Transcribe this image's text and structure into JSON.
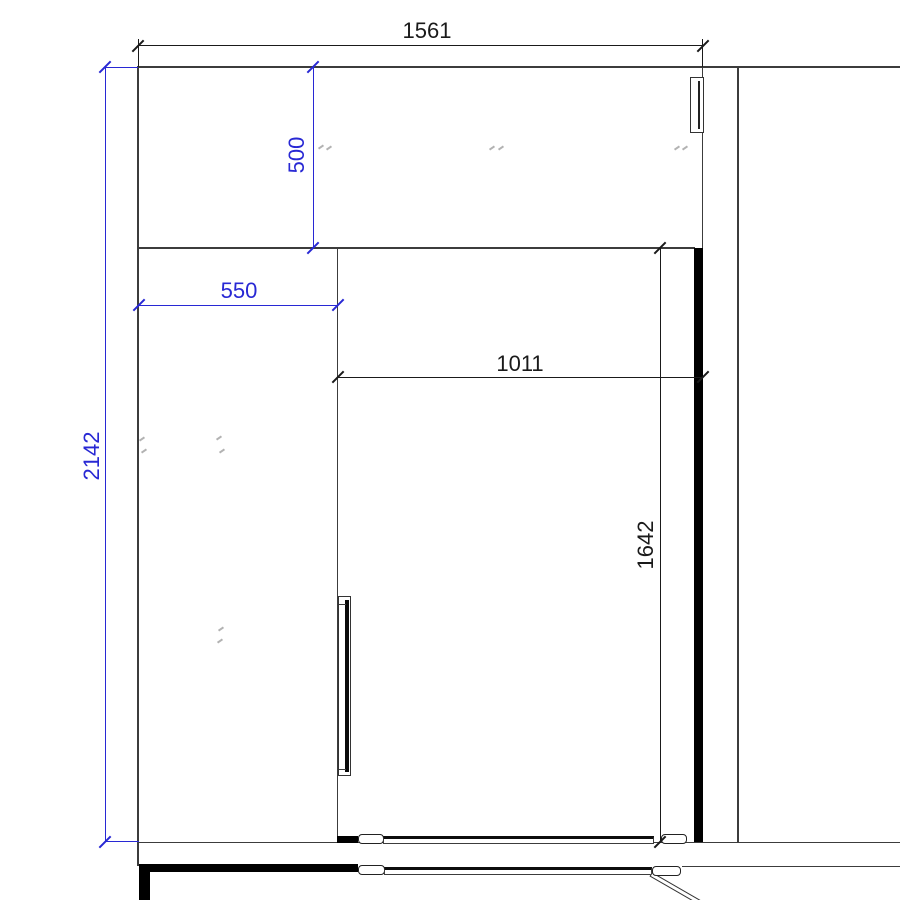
{
  "drawing": {
    "kind": "cad-plan-detail",
    "dims": {
      "d1561": {
        "value": "1561",
        "color": "black",
        "orientation": "horizontal",
        "location": "top-overall-width"
      },
      "d500": {
        "value": "500",
        "color": "blue",
        "orientation": "vertical",
        "location": "upper-section-height"
      },
      "d550": {
        "value": "550",
        "color": "blue",
        "orientation": "horizontal",
        "location": "left-section-width"
      },
      "d2142": {
        "value": "2142",
        "color": "blue",
        "orientation": "vertical",
        "location": "overall-left-height"
      },
      "d1011": {
        "value": "1011",
        "color": "black",
        "orientation": "horizontal",
        "location": "inner-opening-width"
      },
      "d1642": {
        "value": "1642",
        "color": "black",
        "orientation": "vertical",
        "location": "inner-opening-height"
      }
    },
    "colors": {
      "dimension_blue": "#2828d4",
      "dimension_black": "#1a1a1a",
      "wall_line": "#3c3c3c",
      "solid_fill": "#000000",
      "background": "#ffffff"
    }
  }
}
